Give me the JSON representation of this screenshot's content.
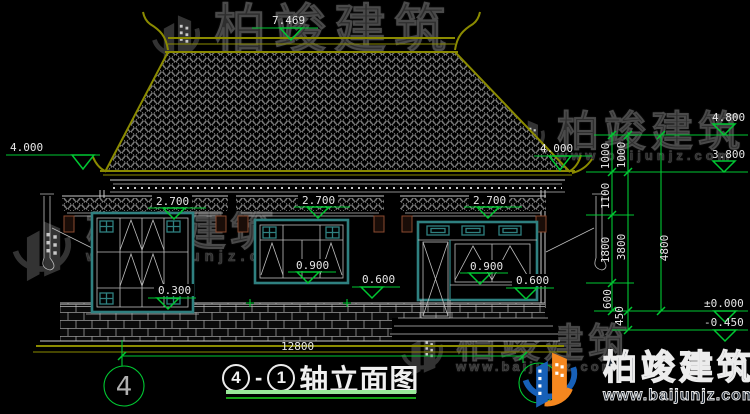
{
  "watermark": {
    "brand": "柏竣建筑",
    "url": "www.baijunjz.com"
  },
  "marks": {
    "ridge": "7.469",
    "eave_left": "4.000",
    "eave_right": "4.000",
    "right_upper": "4.800",
    "right_lower": "3.800",
    "canopy": "2.700",
    "sill": "0.900",
    "wall": "0.600",
    "low_sill": "0.300",
    "ground": "±0.000",
    "footing": "-0.450"
  },
  "dims": {
    "overall_width": "12800",
    "overall_height": "4800",
    "seg_1000a": "1000",
    "seg_1000b": "1000",
    "seg_1100": "1100",
    "seg_1800": "1800",
    "seg_3800": "3800",
    "seg_600": "600",
    "seg_450": "450"
  },
  "axis": {
    "left_bubble": "4"
  },
  "title": {
    "num_left": "4",
    "dash": "-",
    "num_right": "1",
    "text": "轴立面图"
  },
  "colors": {
    "dim_green": "#00c832",
    "line_olive": "#8b8b00",
    "frame_teal": "#2f8080",
    "logo_blue": "#1760b8",
    "logo_orange": "#f5871f"
  }
}
